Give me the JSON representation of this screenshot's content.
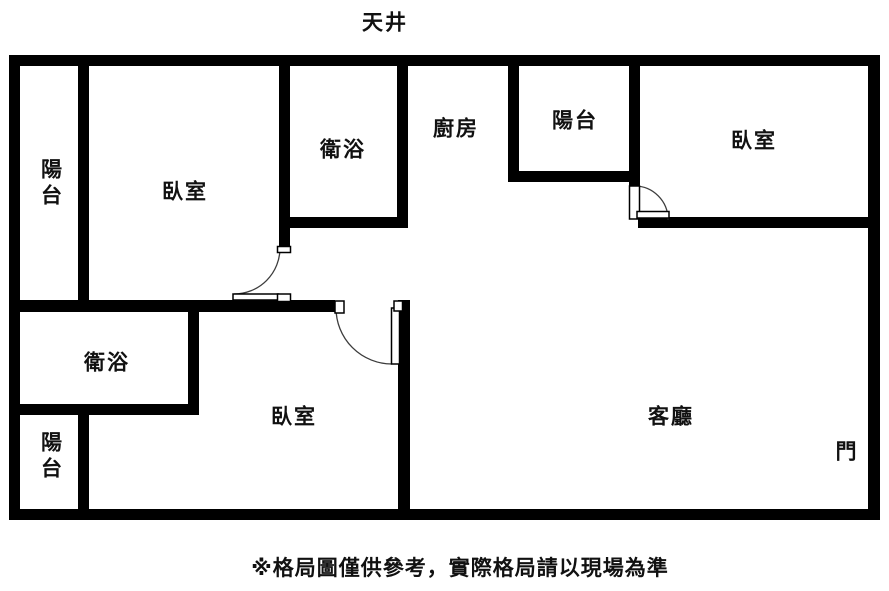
{
  "labels": {
    "skylight": "天井",
    "balcony_top_left": "陽台",
    "bedroom_top_left": "臥室",
    "bathroom_top": "衛浴",
    "kitchen": "廚房",
    "balcony_top_right": "陽台",
    "bedroom_top_right": "臥室",
    "bathroom_bottom": "衛浴",
    "balcony_bottom_left": "陽台",
    "bedroom_bottom": "臥室",
    "living_room": "客廳",
    "entrance_door": "門"
  },
  "disclaimer": "※格局圖僅供參考，實際格局請以現場為準",
  "colors": {
    "wall": "#000000",
    "background": "#ffffff",
    "text": "#111111"
  }
}
